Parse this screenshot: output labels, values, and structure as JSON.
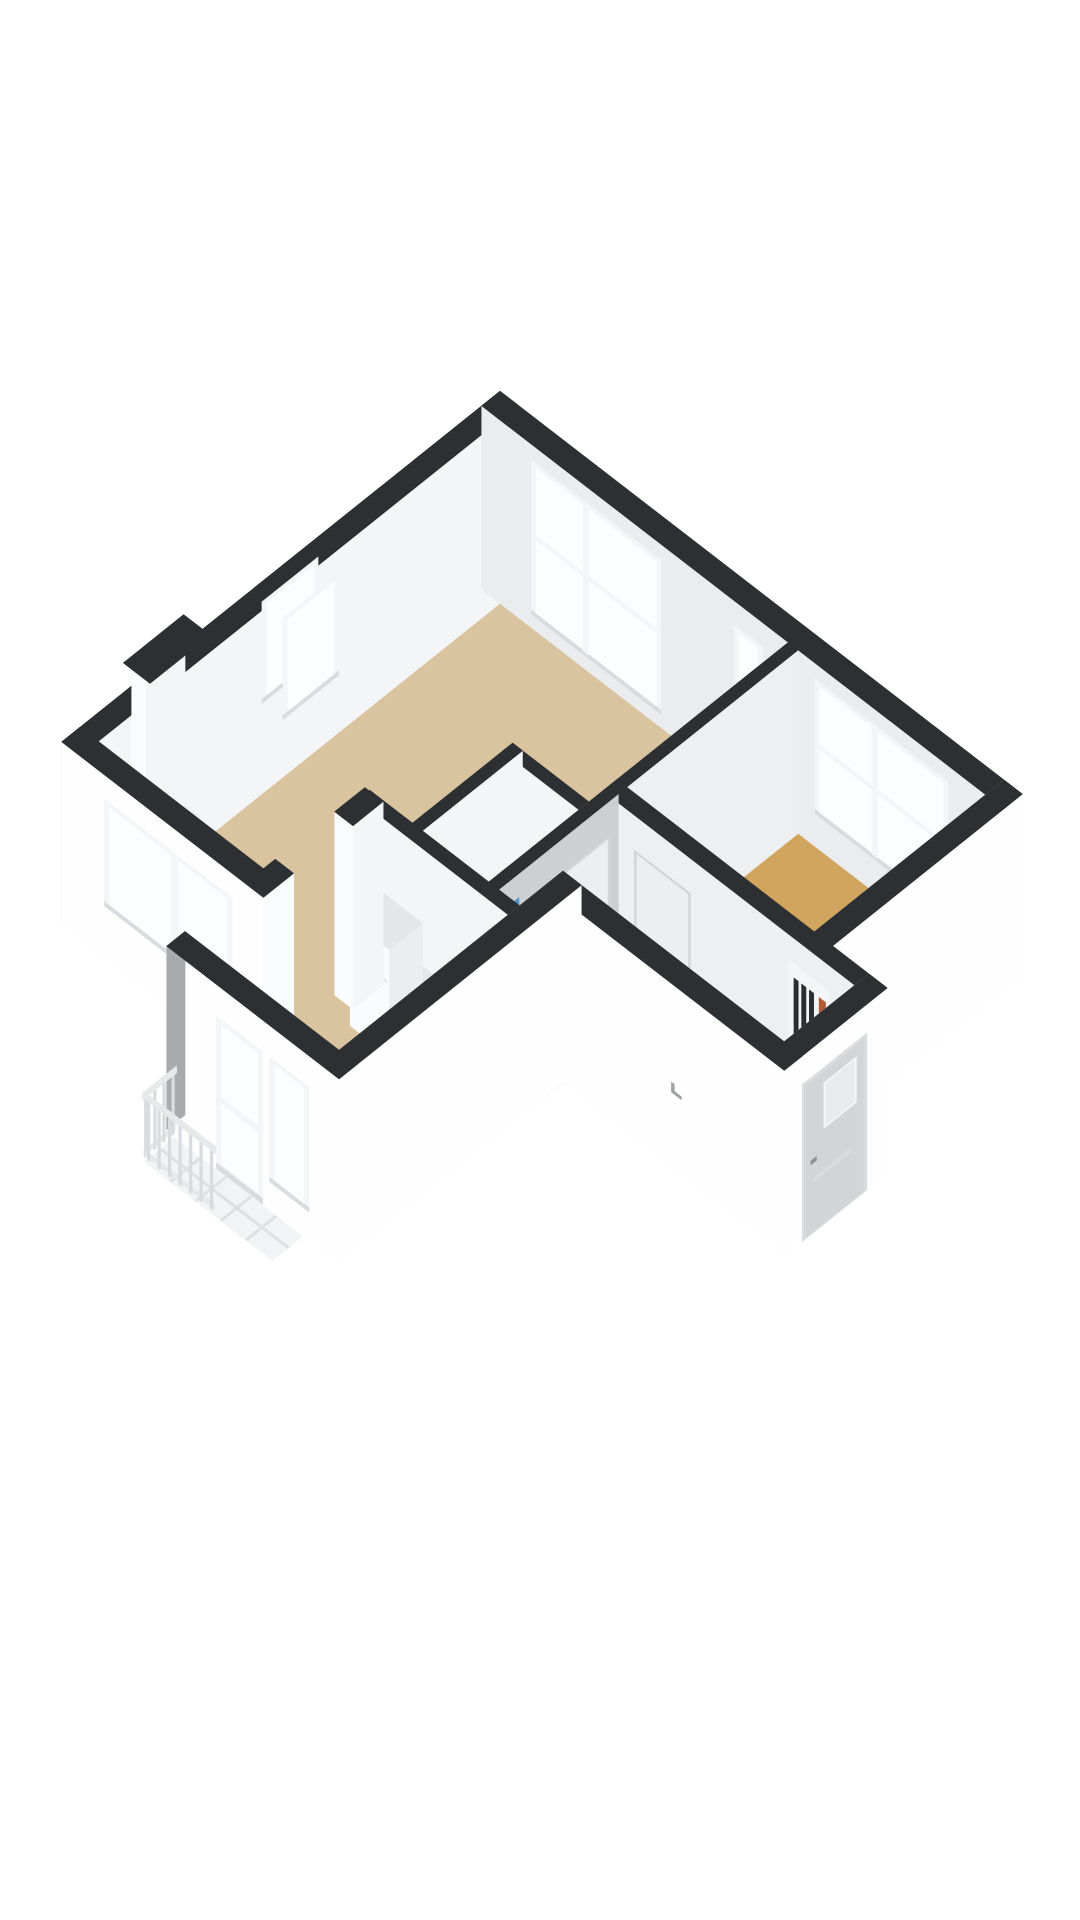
{
  "page": {
    "title": "3D isometric floor plan render of an apartment",
    "background": "#ffffff"
  },
  "colors": {
    "cap": "#2D3033",
    "outerWhite": "#FEFEFE",
    "outerGray": "#A8ABAE",
    "innerBright": "#F4F5F7",
    "innerBright2": "#EDEFF1",
    "innerLight": "#EAECEE",
    "innerGray": "#C7CACC",
    "innerGray2": "#CDD0D2",
    "endWhite": "#FBFCFD",
    "frame": "#F3F5F6",
    "frameShade": "#D9DCDF",
    "glass": "#FCFDFE",
    "floorTan": "#D9C49F",
    "floorGold": "#D1A55E",
    "floorHall": "#C2C5C7",
    "floorBath": "#E9EBEC",
    "balconyTile": "#F1F3F4",
    "balconyJoint": "#DEE1E3",
    "railHand": "#E6E8EA",
    "railPost": "#D9DCDE",
    "blue": "#4E8FC5",
    "blueLight": "#7FB0DA",
    "orange": "#B45B33",
    "meterDark": "#2A2C2E",
    "meterBg": "#F4F5F7",
    "doorFront": "#D2D5D8",
    "doorGlass": "#E8EBED",
    "doorPanel": "#ECEEF0",
    "doorPanelEdge": "#D3D6D9",
    "handleGray": "#8E9194",
    "handleLight": "#ACAFB2",
    "counterFace": "#F7F8F9",
    "counterTop": "#E4E6E8",
    "boxSide": "#EBEDEF",
    "fridgeFace": "#FAFBFC",
    "fridgeSeam": "#E2E4E6",
    "ovenFace": "#EDEFF1",
    "ovenHandle": "#D5D8DB",
    "applianceDark": "#3A3D3F",
    "switchMark": "#9EA1A4",
    "nicheFloor": "#ECEEF0"
  },
  "projection": {
    "k": 70,
    "dx": 54,
    "dy": 56,
    "hz": 70,
    "ox": 80,
    "oy": 925,
    "wallHeight": 2.62
  },
  "scene": {
    "items": [
      {
        "kind": "floor",
        "name": "floor-living-room",
        "color": "floorTan",
        "poly": [
          [
            0.13,
            0.13
          ],
          [
            0.13,
            5.87
          ],
          [
            4.25,
            5.87
          ],
          [
            4.25,
            3.02
          ],
          [
            3.16,
            3.02
          ],
          [
            3.16,
            1.59
          ],
          [
            2.75,
            1.59
          ],
          [
            2.75,
            0.13
          ]
        ]
      },
      {
        "kind": "floor",
        "name": "floor-bathroom",
        "color": "floorBath",
        "poly": [
          [
            3.3,
            1.59
          ],
          [
            3.3,
            2.88
          ],
          [
            4.25,
            2.88
          ],
          [
            4.25,
            1.59
          ]
        ]
      },
      {
        "kind": "floor",
        "name": "floor-hallway",
        "color": "floorHall",
        "poly": [
          [
            4.39,
            1.59
          ],
          [
            4.95,
            1.59
          ],
          [
            4.95,
            2.21
          ],
          [
            7.85,
            2.21
          ],
          [
            7.85,
            3.22
          ],
          [
            4.39,
            3.22
          ]
        ]
      },
      {
        "kind": "floor",
        "name": "floor-bedroom",
        "color": "floorGold",
        "poly": [
          [
            4.39,
            3.42
          ],
          [
            4.39,
            5.87
          ],
          [
            7.07,
            5.87
          ],
          [
            7.07,
            3.42
          ]
        ]
      },
      {
        "kind": "floor",
        "name": "floor-kitchen",
        "color": "floorTan",
        "poly": [
          [
            2.75,
            -0.99
          ],
          [
            2.75,
            1.43
          ],
          [
            4.69,
            1.43
          ],
          [
            4.69,
            -0.99
          ]
        ]
      },
      {
        "kind": "wall",
        "name": "west-exterior-wall",
        "type": "v",
        "rect": [
          -0.13,
          -0.13,
          0.13,
          6.13
        ],
        "faces": {
          "w": "outerGray",
          "e": "innerBright"
        },
        "features": [
          {
            "type": "window",
            "face": "both",
            "a0": 2.75,
            "a1": 3.55,
            "z0": 0.85,
            "z1": 2.3
          },
          {
            "type": "niche",
            "a0": 1.02,
            "a1": 1.88
          }
        ]
      },
      {
        "kind": "wall",
        "name": "north-exterior-wall",
        "type": "h",
        "rect": [
          -0.13,
          5.87,
          7.33,
          6.13
        ],
        "faces": {
          "s": "innerLight"
        },
        "features": [
          {
            "type": "window",
            "face": "s",
            "a0": 0.6,
            "a1": 2.45,
            "z0": 0.22,
            "z1": 2.42,
            "mullion": 0.42,
            "transom": 0.52
          },
          {
            "type": "window",
            "face": "s",
            "a0": 3.5,
            "a1": 3.9,
            "z0": 0.85,
            "z1": 2.3
          },
          {
            "type": "window",
            "face": "s",
            "a0": 4.65,
            "a1": 6.55,
            "z0": 0.5,
            "z1": 2.42,
            "mullion": 0.45,
            "transom": 0.52
          }
        ]
      },
      {
        "kind": "wall",
        "name": "east-exterior-wall",
        "type": "v",
        "rect": [
          7.07,
          3.22,
          7.33,
          6.13
        ],
        "faces": {
          "w": "innerGray",
          "e": "outerWhite",
          "s_end": "endWhite"
        }
      },
      {
        "kind": "wall",
        "name": "living-bedroom-divider-wall",
        "type": "v",
        "rect": [
          4.25,
          3.22,
          4.39,
          5.87
        ],
        "faces": {
          "w": "innerBright",
          "e": "innerBright2"
        }
      },
      {
        "kind": "wall",
        "name": "hallway-north-wall",
        "type": "h",
        "rect": [
          4.25,
          3.22,
          8.11,
          3.42
        ],
        "faces": {
          "s": "innerBright2",
          "e_end": "endWhite"
        },
        "features": [
          {
            "type": "door-panel",
            "face": "s",
            "a0": 4.72,
            "a1": 5.52
          },
          {
            "type": "meter-cupboard",
            "face": "s",
            "a0": 6.92,
            "a1": 7.5
          }
        ]
      },
      {
        "kind": "wall",
        "name": "bathroom-north-wall",
        "type": "h",
        "rect": [
          3.16,
          2.88,
          4.39,
          3.02
        ],
        "faces": {
          "s": "innerBright"
        }
      },
      {
        "kind": "wall",
        "name": "bathroom-west-wall",
        "type": "v",
        "rect": [
          3.16,
          1.51,
          3.3,
          3.02
        ],
        "faces": {
          "w": "innerGray2",
          "e": "innerBright",
          "s_end": "endWhite"
        }
      },
      {
        "kind": "wall",
        "name": "bathroom-hallway-wall",
        "type": "v",
        "rect": [
          4.25,
          1.43,
          4.39,
          3.3
        ],
        "faces": {
          "w": "innerBright",
          "e": "innerGray2",
          "s_end": "endWhite"
        },
        "features": [
          {
            "type": "shower-glass",
            "face": "w",
            "a0": 1.6,
            "a1": 2.04
          },
          {
            "type": "door-panel",
            "face": "e",
            "a0": 2.38,
            "a1": 3.16
          }
        ]
      },
      {
        "kind": "wall",
        "name": "entry-door-wall",
        "type": "v",
        "rect": [
          7.85,
          1.95,
          8.11,
          3.42
        ],
        "faces": {
          "w": "innerGray",
          "e": "outerWhite",
          "s_end": "endWhite"
        },
        "features": [
          {
            "type": "front-door",
            "face": "e",
            "a0": 2.24,
            "a1": 3.06
          }
        ]
      },
      {
        "kind": "wall",
        "name": "entry-south-wall",
        "type": "h",
        "rect": [
          4.69,
          1.95,
          8.11,
          2.21
        ],
        "faces": {
          "s": "outerWhite"
        },
        "features": [
          {
            "type": "switch-mark",
            "face": "s",
            "a0": 6.52,
            "a1": 6.66
          }
        ]
      },
      {
        "kind": "wall",
        "name": "kitchen-north-wall",
        "type": "h",
        "rect": [
          2.55,
          1.43,
          4.89,
          1.59
        ],
        "faces": {
          "s": "innerBright"
        }
      },
      {
        "kind": "box",
        "name": "kitchen-counter",
        "rect": [
          2.88,
          1.0,
          4.68,
          1.43
        ],
        "h": 0.93,
        "face": "counterFace",
        "top": "counterTop",
        "details": [
          {
            "f": [
              3.58,
              3.65,
              0.8,
              0.87
            ],
            "c": "applianceDark"
          },
          {
            "f": [
              3.7,
              3.77,
              0.8,
              0.87
            ],
            "c": "applianceDark"
          },
          {
            "f": [
              3.82,
              3.89,
              0.8,
              0.87
            ],
            "c": "applianceDark"
          },
          {
            "f": [
              3.94,
              4.01,
              0.8,
              0.87
            ],
            "c": "applianceDark"
          },
          {
            "f": [
              4.22,
              4.27,
              0.78,
              0.84
            ],
            "c": "applianceDark"
          },
          {
            "f": [
              4.32,
              4.37,
              0.78,
              0.84
            ],
            "c": "applianceDark"
          },
          {
            "f": [
              3.58,
              4.14,
              0.14,
              0.7
            ],
            "c": "ovenFace"
          },
          {
            "f": [
              3.6,
              4.12,
              0.6,
              0.66
            ],
            "c": "ovenHandle"
          }
        ]
      },
      {
        "kind": "box",
        "name": "kitchen-tall-unit",
        "rect": [
          2.88,
          0.98,
          3.44,
          1.45
        ],
        "h": 1.52,
        "face": "fridgeFace",
        "top": "counterTop",
        "details": [
          {
            "f": [
              2.9,
              3.42,
              1.05,
              1.08
            ],
            "c": "fridgeSeam"
          }
        ]
      },
      {
        "kind": "wall",
        "name": "kitchen-east-wall",
        "type": "v",
        "rect": [
          4.69,
          -1.25,
          4.95,
          2.21
        ],
        "faces": {
          "w": "innerGray2",
          "e": "outerWhite",
          "s_end": "endWhite"
        }
      },
      {
        "kind": "wall",
        "name": "kitchen-west-wall-upper",
        "type": "v",
        "rect": [
          2.49,
          1.15,
          2.75,
          1.58
        ],
        "faces": {
          "w": "outerGray",
          "e": "innerBright",
          "s_end": "endWhite"
        }
      },
      {
        "kind": "wall",
        "name": "kitchen-west-wall-lower",
        "type": "v",
        "rect": [
          2.49,
          -1.25,
          2.75,
          0.3
        ],
        "faces": {
          "w": "outerGray",
          "e": "innerBright",
          "n_end": "endWhite"
        }
      },
      {
        "kind": "wall",
        "name": "living-south-wall",
        "type": "h",
        "rect": [
          -0.13,
          -0.13,
          2.75,
          0.13
        ],
        "faces": {
          "s": "outerWhite",
          "e_end": "endWhite"
        },
        "features": [
          {
            "type": "window",
            "face": "s",
            "a0": 0.5,
            "a1": 2.32,
            "z0": 0.78,
            "z1": 2.3,
            "mullion": 0.55
          }
        ]
      },
      {
        "kind": "wall",
        "name": "kitchen-south-wall",
        "type": "h",
        "rect": [
          2.49,
          -1.25,
          4.95,
          -0.99
        ],
        "faces": {
          "s": "outerWhite",
          "w_end": "outerGray"
        },
        "features": [
          {
            "type": "glass-door",
            "face": "s",
            "a0": 3.22,
            "a1": 3.88
          },
          {
            "type": "window",
            "face": "s",
            "a0": 3.98,
            "a1": 4.54,
            "z0": 0.42,
            "z1": 2.2
          }
        ]
      },
      {
        "kind": "floor",
        "name": "floor-balcony",
        "color": "balconyTile",
        "joints": true,
        "poly": [
          [
            2.62,
            -1.7
          ],
          [
            2.62,
            -1.27
          ],
          [
            4.45,
            -1.27
          ],
          [
            4.45,
            -1.7
          ]
        ]
      },
      {
        "kind": "railing",
        "name": "balcony-railing",
        "w": {
          "x": 2.62,
          "y0": -1.68,
          "y1": -1.29,
          "n": 4
        },
        "s": {
          "y": -1.7,
          "x0": 2.68,
          "x1": 3.58,
          "n": 7
        }
      }
    ],
    "balcony_joints": {
      "xs": [
        2.98,
        3.34,
        3.7,
        4.06
      ],
      "ys": [
        -1.485
      ]
    }
  }
}
